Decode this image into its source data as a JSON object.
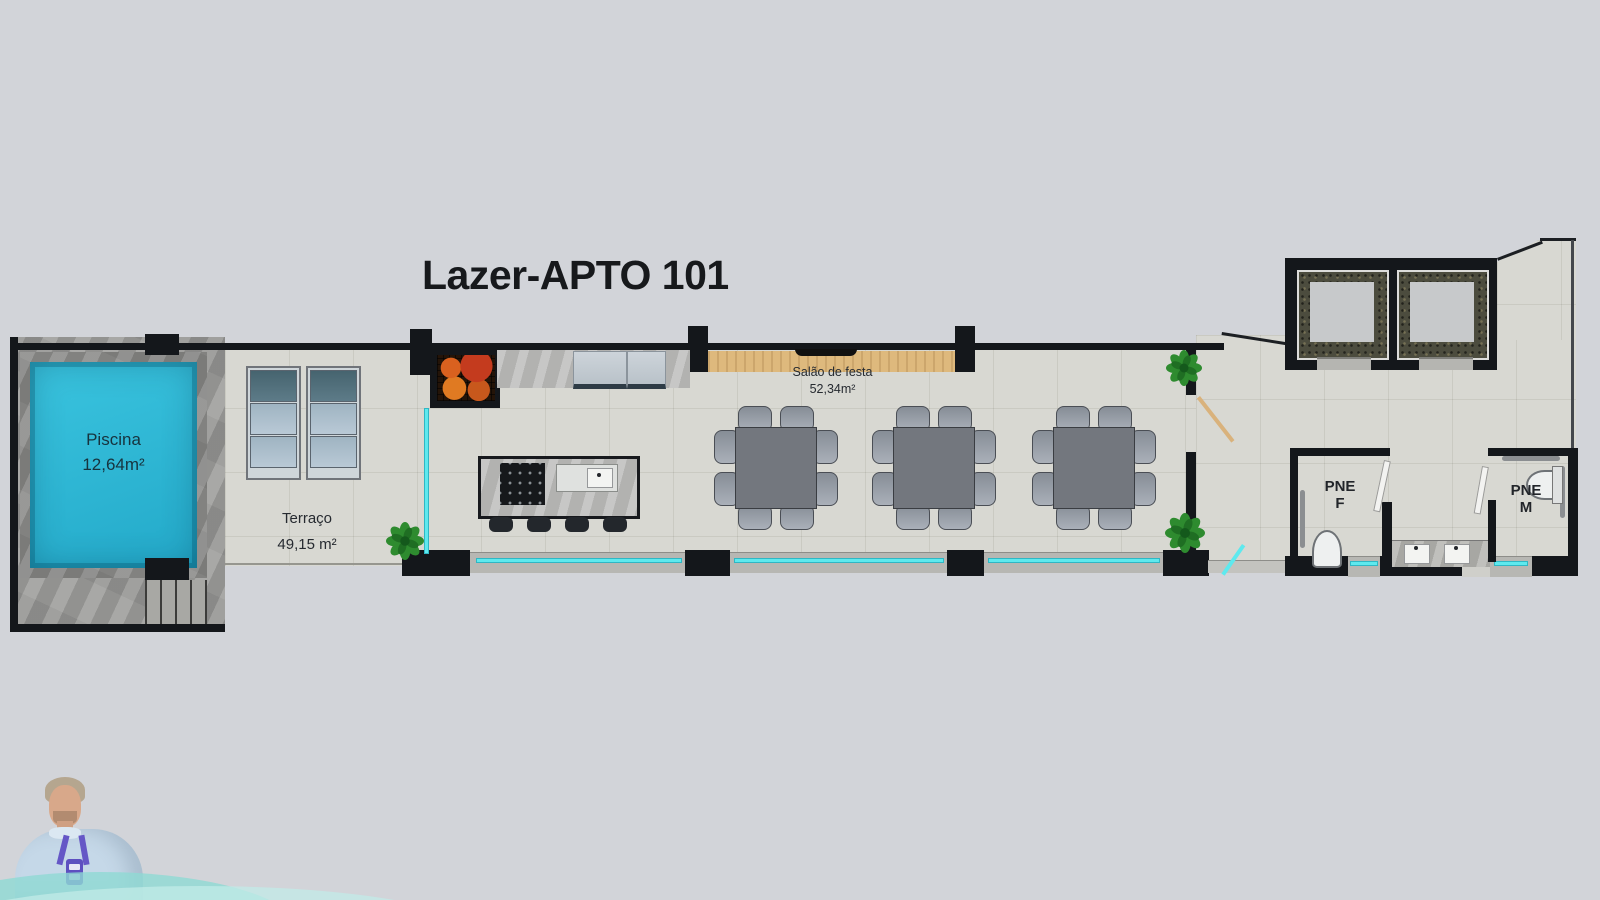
{
  "title": "Lazer-APTO 101",
  "plan": {
    "pool": {
      "name": "Piscina",
      "area": "12,64m²"
    },
    "terrace": {
      "name": "Terraço",
      "area": "49,15 m²"
    },
    "party_hall": {
      "name": "Salão de festa",
      "area": "52,34m²"
    },
    "accessible_wc_female": {
      "abbr": "PNE",
      "letter": "F"
    },
    "accessible_wc_male": {
      "abbr": "PNE",
      "letter": "M"
    }
  },
  "colors": {
    "page_background": "#d2d4d9",
    "floor_tile": "#d8d8d2",
    "stone_deck": "#9e9e9c",
    "pool_water": "#2fb9d6",
    "wall": "#14171b",
    "window_glass": "#5ee9ee",
    "wood": "#deb97d",
    "table_top": "#73777e",
    "chair": "#9aa1ab",
    "plant_green": "#2e8b2f",
    "grill_accent": "#d9611f",
    "lanyard_purple": "#5d4fc0"
  }
}
